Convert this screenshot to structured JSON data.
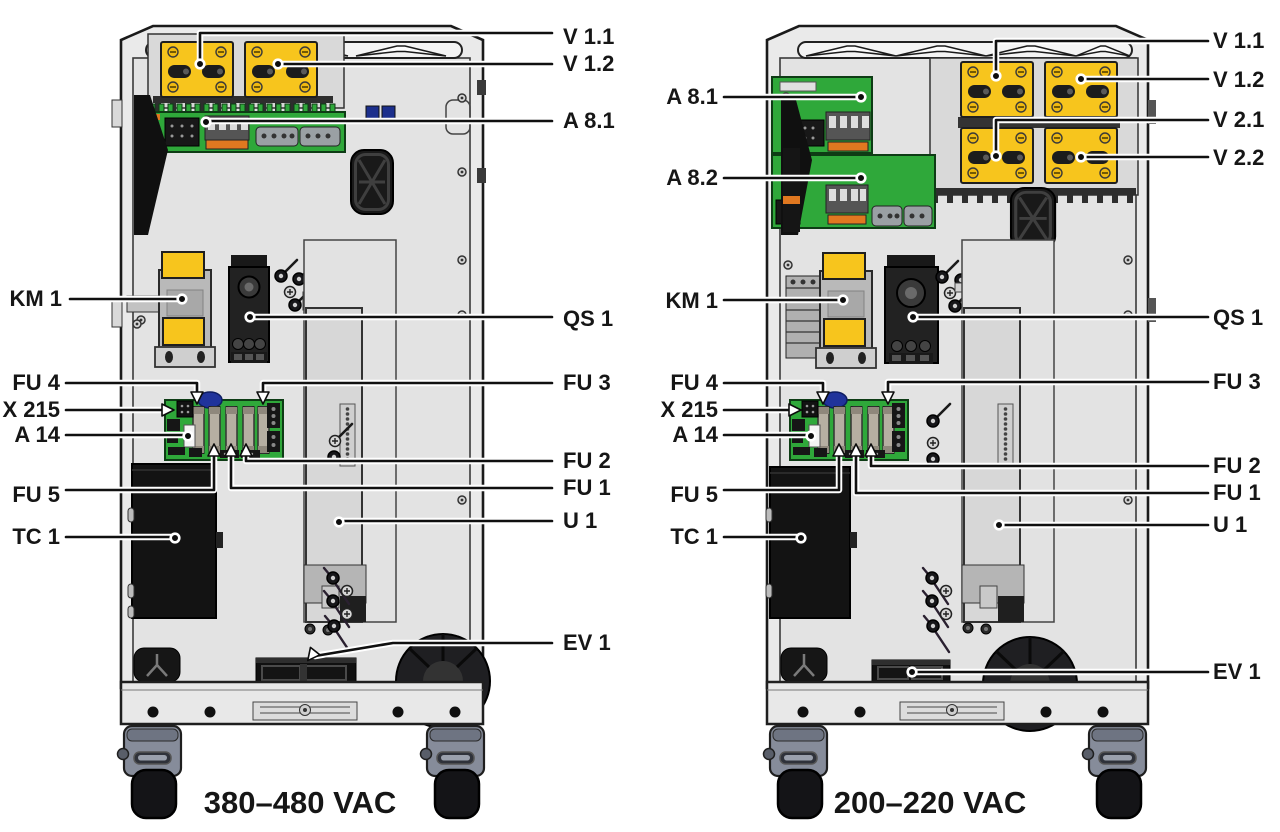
{
  "diagram": {
    "left": {
      "caption": "380–480 VAC",
      "labels": {
        "v11": "V 1.1",
        "v12": "V 1.2",
        "a81": "A 8.1",
        "km1": "KM 1",
        "qs1": "QS 1",
        "fu4": "FU 4",
        "x215": "X 215",
        "a14": "A 14",
        "fu3": "FU 3",
        "fu2": "FU 2",
        "fu1": "FU 1",
        "fu5": "FU 5",
        "u1": "U 1",
        "tc1": "TC 1",
        "ev1": "EV 1"
      }
    },
    "right": {
      "caption": "200–220 VAC",
      "labels": {
        "v11": "V 1.1",
        "v12": "V 1.2",
        "v21": "V 2.1",
        "v22": "V 2.2",
        "a81": "A 8.1",
        "a82": "A 8.2",
        "km1": "KM 1",
        "qs1": "QS 1",
        "fu4": "FU 4",
        "x215": "X 215",
        "a14": "A 14",
        "fu3": "FU 3",
        "fu2": "FU 2",
        "fu1": "FU 1",
        "fu5": "FU 5",
        "u1": "U 1",
        "tc1": "TC 1",
        "ev1": "EV 1"
      }
    },
    "colors": {
      "module_yellow": "#f7c51d",
      "pcb_green": "#2fa83a",
      "cabinet_gray": "#eaeaea",
      "line_black": "#101010"
    }
  }
}
